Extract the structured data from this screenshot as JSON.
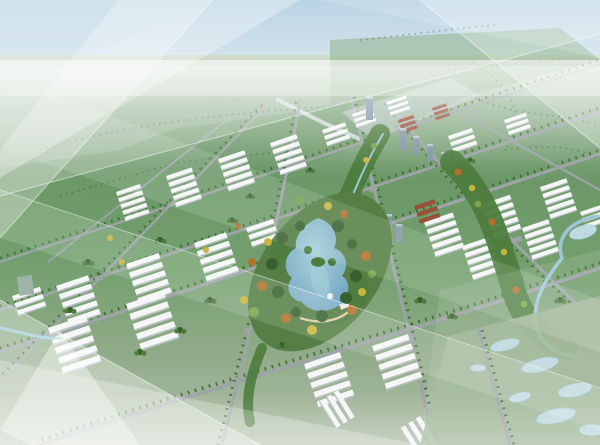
{
  "scene": {
    "type": "aerial-masterplan-rendering",
    "elements": [
      "sky",
      "distant-farmland",
      "highway",
      "road-grid",
      "industrial-blocks",
      "town-center",
      "central-park",
      "lake",
      "green-corridor",
      "river-corridor",
      "wetland",
      "glass-light-overlay"
    ]
  },
  "colors": {
    "sky_top": "#a9c9de",
    "sky_horizon": "#e8f0f2",
    "field_pale": "#c6d3c2",
    "field_far": "#93b292",
    "field_deep": "#6c9868",
    "field_mid": "#74a06f",
    "field_near": "#92ab8a",
    "field_bottom": "#b3c2ac",
    "veg_dark": "#38602f",
    "veg_med": "#4d7c3d",
    "veg_light": "#7da44b",
    "autumn_orange": "#b3702a",
    "autumn_yellow": "#c9b43c",
    "lake_core": "#a9d0dc",
    "lake_edge": "#6fa3bf",
    "river": "#9cc8d6",
    "road": "#9da4a6",
    "road_light": "#ccd6da",
    "building": "#f5f7f6",
    "building_shadow": "#b7bfc1",
    "roof_red": "#9a4f38",
    "tower": "#8496a6",
    "tower_light": "#b8c6d0",
    "wetland": "#9eb697",
    "pond": "#bed9df",
    "overlay": "#ffffff"
  }
}
